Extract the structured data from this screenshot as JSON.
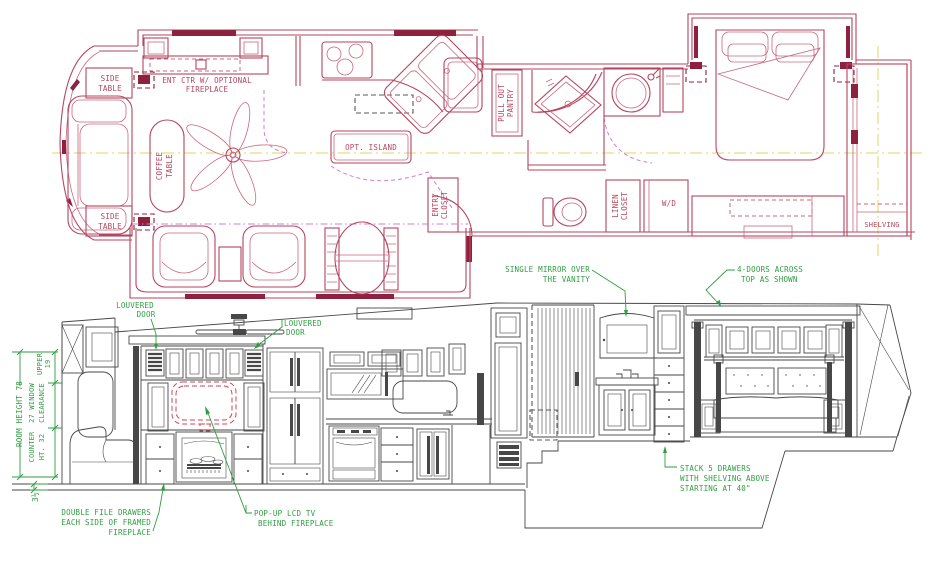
{
  "drawing": {
    "colors": {
      "plan_line": "#b5455f",
      "plan_bold": "#8e2040",
      "slide_magenta": "#cf7fcf",
      "centerline_yellow": "#ddd566",
      "elevation_line": "#474747",
      "annotation_green": "#2f9e41",
      "tv_dashed_red": "#c84a55"
    }
  },
  "floor_plan": {
    "side_table_top": [
      "SIDE",
      "TABLE"
    ],
    "side_table_bottom": [
      "SIDE",
      "TABLE"
    ],
    "ent_ctr": [
      "ENT CTR W/ OPTIONAL",
      "FIREPLACE"
    ],
    "coffee_table": [
      "COFFEE",
      "TABLE"
    ],
    "opt_island": "OPT. ISLAND",
    "pull_out_pantry": [
      "PULL OUT",
      "PANTRY"
    ],
    "entry_closet": [
      "ENTRY",
      "CLOSET"
    ],
    "linen_closet": [
      "LINEN",
      "CLOSET"
    ],
    "washer_dryer": "W/D",
    "shelving": "SHELVING"
  },
  "elevation": {
    "louvered_door_left": [
      "LOUVERED",
      "DOOR"
    ],
    "louvered_door_right": [
      "LOUVERED",
      "DOOR"
    ],
    "single_mirror": [
      "SINGLE MIRROR OVER",
      "THE VANITY"
    ],
    "four_doors": [
      "4-DOORS ACROSS",
      "TOP AS SHOWN"
    ],
    "double_file_drawers": [
      "DOUBLE FILE DRAWERS",
      "EACH SIDE OF FRAMED",
      "FIREPLACE"
    ],
    "popup_tv": [
      "POP-UP LCD TV",
      "BEHIND FIREPLACE"
    ],
    "stack_drawers": [
      "STACK 5 DRAWERS",
      "WITH SHELVING ABOVE",
      "STARTING AT 40\""
    ],
    "dimensions": {
      "room_height": "ROOM HEIGHT 78",
      "upper": [
        "UPPER",
        "19"
      ],
      "window_clearance": [
        "27 WINDOW",
        "CLEARANCE"
      ],
      "counter": [
        "COUNTER",
        "HT. 32"
      ],
      "floor_thickness": "3½"
    }
  }
}
